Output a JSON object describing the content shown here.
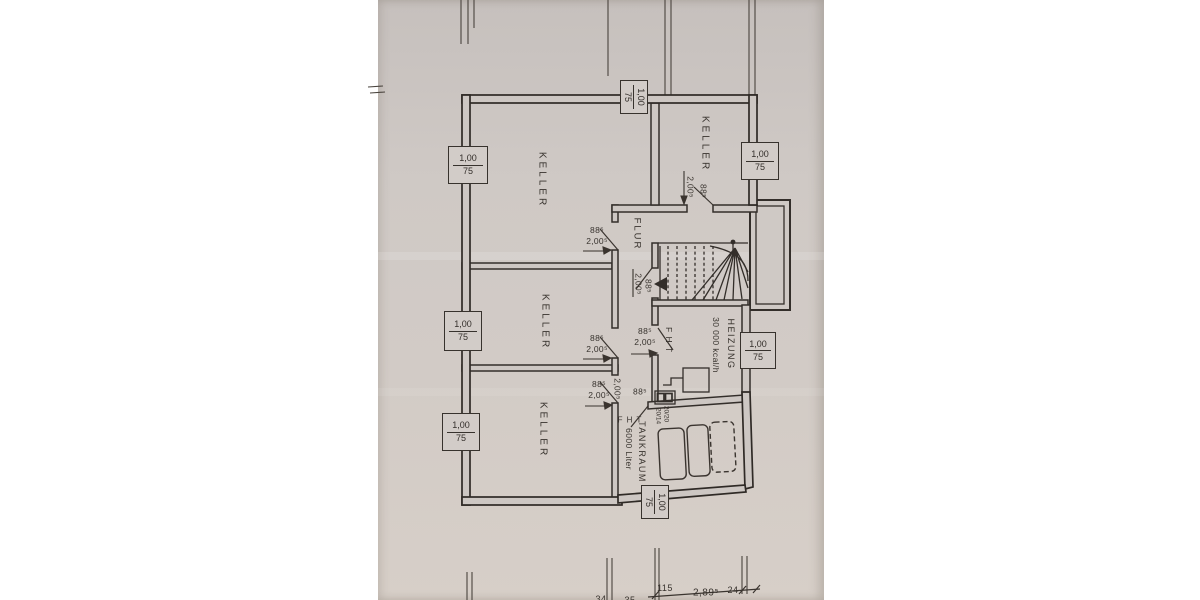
{
  "drawing": {
    "kind": "basement floor plan (scanned photo)",
    "colors": {
      "paper": "#cfc9c5",
      "ink": "#332e2a",
      "margin": "#ffffff"
    }
  },
  "rooms": {
    "keller": "KELLER",
    "flur": "FLUR",
    "heizung": "HEIZUNG",
    "heizung_capacity": "30 000 kcal/h",
    "tankraum": "TANKRAUM",
    "tankraum_capacity": "6000 Liter",
    "fire_door": "F H T"
  },
  "window_label": {
    "width": "1,00",
    "height": "75"
  },
  "door_label": {
    "width": "88⁵",
    "height": "2,00⁵"
  },
  "chimney": {
    "flue_a": "20/20",
    "flue_b": "20/14"
  },
  "bottom_dimensions": {
    "a": "115",
    "b": "2,89⁵",
    "c": "24",
    "partial_left": "34",
    "partial_mid": "35"
  }
}
